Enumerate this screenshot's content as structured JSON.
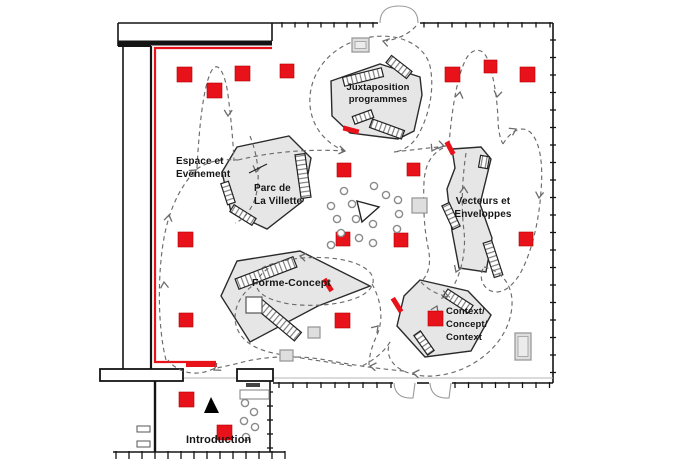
{
  "title": "Exhibition floor plan",
  "labels": {
    "juxtaposition": "Juxtaposition\nprogrammes",
    "espace": "Espace et\nEvenement",
    "parc": "Parc de\nLa Villette",
    "vecteurs": "Vecteurs et\nEnveloppes",
    "forme": "Forme-Concept",
    "context": "Context/\nConcept/\nContext",
    "introduction": "Introduction"
  },
  "colors": {
    "red": "#e8121a",
    "red_dark": "#b50000",
    "platform": "#e6e6e6",
    "platform_edge": "#2b2b2b",
    "wall": "#141414",
    "dash": "#6b6b6b",
    "light_wall": "#b5b5b5",
    "door": "#9a9a9a",
    "circle_edge": "#8a8a8a",
    "gray_fill": "#dedede",
    "gray_edge": "#9a9a9a"
  },
  "plan": {
    "walls": [
      [
        118,
        23,
        378,
        23,
        1.6
      ],
      [
        420,
        23,
        553,
        23,
        1.6
      ],
      [
        553,
        23,
        553,
        383,
        1.6
      ],
      [
        118,
        23,
        118,
        46,
        1.6
      ],
      [
        272,
        23,
        272,
        41,
        1.6
      ],
      [
        118,
        43,
        272,
        43,
        5
      ],
      [
        123,
        46,
        123,
        369,
        1.6
      ],
      [
        151,
        46,
        151,
        369,
        2.2
      ],
      [
        118,
        46,
        151,
        46,
        2
      ],
      [
        273,
        383,
        393,
        383,
        1.6
      ],
      [
        417,
        383,
        429,
        383,
        1.6
      ],
      [
        452,
        383,
        553,
        383,
        1.6
      ],
      [
        155,
        381,
        155,
        452,
        2.4
      ],
      [
        270,
        381,
        270,
        452,
        1.6
      ],
      [
        113,
        452,
        285,
        452,
        1.6
      ]
    ],
    "light_walls": [
      [
        183,
        378,
        553,
        378,
        1.0
      ]
    ],
    "hollow_walls": [
      [
        100,
        369,
        83,
        12
      ],
      [
        237,
        369,
        36,
        12
      ]
    ],
    "tick_groups": [
      {
        "x": 282,
        "y": 23,
        "step": 13,
        "count": 8,
        "orient": "v",
        "len": 4.5
      },
      {
        "x": 424,
        "y": 23,
        "step": 14,
        "count": 10,
        "orient": "v",
        "len": 4.5
      },
      {
        "x": 553,
        "y": 40,
        "step": 17.5,
        "count": 20,
        "orient": "h",
        "len": 6
      },
      {
        "x": 279,
        "y": 383,
        "step": 14,
        "count": 9,
        "orient": "v",
        "len": 5
      },
      {
        "x": 455,
        "y": 383,
        "step": 13.5,
        "count": 8,
        "orient": "v",
        "len": 5
      },
      {
        "x": 270,
        "y": 392,
        "step": 14,
        "count": 5,
        "orient": "h",
        "len": 6
      },
      {
        "x": 116,
        "y": 452,
        "step": 13,
        "count": 14,
        "orient": "v",
        "len": 7
      }
    ],
    "door_arcs": [
      "M 380,23 Q 380,6 399,6",
      "M 418,23 Q 418,6 399,6",
      "M 394,383 Q 395,399 413,398 L 415,383",
      "M 430,383 Q 431,399 449,398 L 451,383"
    ],
    "red_line": "M 272,48 L 155,48 L 155,362 L 216,362",
    "red_line_end": [
      186,
      365,
      217,
      365
    ],
    "platforms": [
      {
        "name": "platform-juxtaposition",
        "points": "331,81 380,64 420,77 422,95 414,131 398,139 350,133 332,116"
      },
      {
        "name": "platform-parc-la-villette",
        "points": "237,147 289,136 311,158 303,201 267,229 231,212 222,172"
      },
      {
        "name": "platform-vecteurs",
        "points": "452,149 481,147 491,159 480,204 492,238 486,272 459,268 452,231 447,189 455,168"
      },
      {
        "name": "platform-forme-concept",
        "points": "300,251 370,286 318,306 250,342 221,296 237,261"
      },
      {
        "name": "platform-context",
        "points": "420,280 468,291 491,315 471,351 425,357 397,326 404,296"
      }
    ],
    "benches": [
      [
        363,
        77,
        40,
        9,
        -14
      ],
      [
        399,
        67,
        26,
        9,
        38
      ],
      [
        363,
        117,
        20,
        8,
        -20
      ],
      [
        387,
        129,
        34,
        9,
        20
      ],
      [
        228,
        193,
        22,
        8,
        72
      ],
      [
        243,
        215,
        26,
        8,
        32
      ],
      [
        303,
        176,
        44,
        10,
        82
      ],
      [
        451,
        216,
        26,
        8,
        65
      ],
      [
        493,
        259,
        36,
        9,
        72
      ],
      [
        484,
        162,
        9,
        12,
        10
      ],
      [
        266,
        273,
        62,
        11,
        -21
      ],
      [
        278,
        320,
        52,
        11,
        40
      ],
      [
        458,
        301,
        30,
        9,
        33
      ],
      [
        424,
        343,
        24,
        8,
        55
      ]
    ],
    "red_wedges": [
      [
        351,
        130,
        16,
        5,
        15
      ],
      [
        450,
        148,
        14,
        5,
        62
      ],
      [
        328,
        285,
        14,
        5,
        58
      ],
      [
        397,
        305,
        16,
        5,
        58
      ]
    ],
    "red_squares": [
      [
        177,
        67,
        15
      ],
      [
        207,
        83,
        15
      ],
      [
        235,
        66,
        15
      ],
      [
        280,
        64,
        14
      ],
      [
        445,
        67,
        15
      ],
      [
        484,
        60,
        13
      ],
      [
        520,
        67,
        15
      ],
      [
        337,
        163,
        14
      ],
      [
        407,
        163,
        13
      ],
      [
        178,
        232,
        15
      ],
      [
        336,
        232,
        14
      ],
      [
        394,
        233,
        14
      ],
      [
        519,
        232,
        14
      ],
      [
        179,
        313,
        14
      ],
      [
        335,
        313,
        15
      ],
      [
        428,
        311,
        15
      ],
      [
        179,
        392,
        15
      ],
      [
        217,
        425,
        15
      ]
    ],
    "gray_squares": [
      [
        352,
        38,
        17,
        14,
        1
      ],
      [
        412,
        198,
        15,
        15,
        0
      ],
      [
        308,
        327,
        12,
        11,
        0
      ],
      [
        280,
        350,
        13,
        11,
        0
      ],
      [
        515,
        333,
        16,
        27,
        1
      ]
    ],
    "white_squares": [
      [
        246,
        297,
        16,
        16
      ]
    ],
    "fixtures": {
      "outlets": [
        [
          137,
          426,
          13,
          6
        ],
        [
          137,
          441,
          13,
          6
        ]
      ],
      "shelf": [
        240,
        390,
        29,
        9
      ],
      "bar": [
        246,
        383,
        14,
        4
      ]
    },
    "circles": [
      [
        344,
        191
      ],
      [
        374,
        186
      ],
      [
        386,
        195
      ],
      [
        398,
        200
      ],
      [
        331,
        206
      ],
      [
        352,
        204
      ],
      [
        399,
        214
      ],
      [
        337,
        219
      ],
      [
        356,
        219
      ],
      [
        373,
        224
      ],
      [
        341,
        233
      ],
      [
        359,
        238
      ],
      [
        373,
        243
      ],
      [
        331,
        245
      ],
      [
        397,
        229
      ],
      [
        245,
        403
      ],
      [
        254,
        412
      ],
      [
        244,
        421
      ],
      [
        255,
        427
      ],
      [
        246,
        437
      ]
    ],
    "triangles": [
      {
        "name": "triangle-outline-center",
        "points": "357,201 379,207 362,222",
        "fill": "none"
      },
      {
        "name": "triangle-solid-introduction",
        "points": "204,413 211,397 219,413",
        "fill": "#000000"
      }
    ],
    "pointer_lines": [
      [
        249,
        173,
        267,
        164
      ]
    ],
    "dashed_paths": [
      "M 197,168 C 199,130 203,85 212,70 C 219,59 226,78 228,95 C 231,118 233,140 234,161",
      "M 166,360 C 157,325 158,270 164,238 C 169,210 180,186 197,169 C 210,160 224,159 238,160",
      "M 238,160 C 275,151 312,149 345,151",
      "M 345,151 C 317,140 306,114 311,89 C 317,60 342,41 371,37 C 397,33 424,43 430,66 C 435,89 429,117 417,137 C 411,146 403,151 394,152",
      "M 416,26 C 409,34 398,39 386,41",
      "M 394,152 C 411,150 429,148 446,146",
      "M 449,145 C 451,118 456,78 466,59 C 472,48 482,47 487,58 C 493,72 497,96 498,119 C 498,129 500,139 503,144",
      "M 503,144 C 511,130 524,124 532,134 C 541,145 543,167 541,191 C 539,221 532,251 521,272 C 512,288 500,296 489,290 C 481,285 479,275 484,267",
      "M 443,148 C 431,154 425,165 424,182 C 423,205 424,228 428,247 C 431,261 430,273 421,282",
      "M 466,153 C 462,180 461,208 464,231 C 466,250 462,271 453,287",
      "M 484,267 C 499,270 511,282 512,300 C 513,324 499,348 474,363 C 453,376 425,380 406,372 C 391,366 385,354 390,342",
      "M 421,282 C 428,290 438,295 450,297",
      "M 390,342 C 384,352 374,360 362,366",
      "M 372,284 C 381,300 384,319 377,335 C 372,346 369,356 369,365",
      "M 262,268 C 281,258 320,254 348,261 C 371,267 379,279 369,290 C 357,303 319,308 290,304 C 266,300 252,291 258,280 C 260,275 264,271 269,268",
      "M 258,282 C 241,292 232,309 236,325 C 240,340 254,349 273,353 C 303,359 330,362 352,366",
      "M 404,371 C 380,369 352,365 326,360 C 298,355 267,356 243,362 C 229,366 220,367 213,369 C 196,377 178,373 168,360",
      "M 250,136 C 258,156 261,180 255,199 C 250,212 243,220 235,223"
    ],
    "arrows": [
      [
        383,
        41,
        195
      ],
      [
        228,
        116,
        92
      ],
      [
        196,
        170,
        -38
      ],
      [
        164,
        282,
        -95
      ],
      [
        169,
        215,
        -80
      ],
      [
        345,
        151,
        10
      ],
      [
        444,
        146,
        12
      ],
      [
        460,
        92,
        -80
      ],
      [
        497,
        97,
        100
      ],
      [
        516,
        129,
        -28
      ],
      [
        539,
        198,
        96
      ],
      [
        432,
        151,
        118
      ],
      [
        464,
        187,
        -88
      ],
      [
        456,
        272,
        112
      ],
      [
        448,
        296,
        15
      ],
      [
        413,
        373,
        188
      ],
      [
        370,
        366,
        188
      ],
      [
        214,
        370,
        148
      ],
      [
        300,
        256,
        192
      ],
      [
        378,
        326,
        -48
      ],
      [
        437,
        306,
        -65
      ],
      [
        256,
        172,
        100
      ]
    ]
  }
}
